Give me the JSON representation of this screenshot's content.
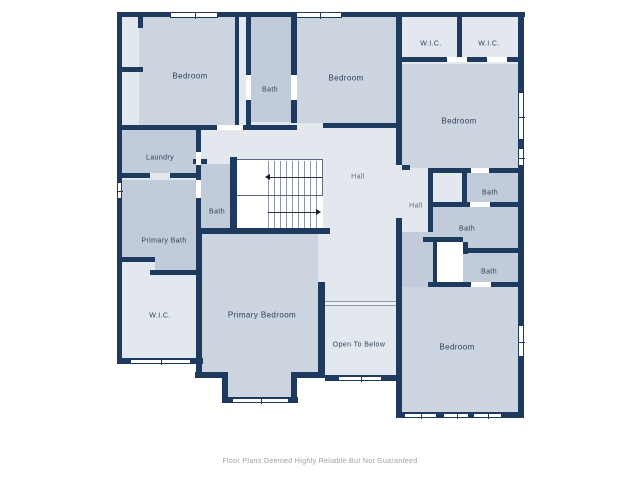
{
  "plan": {
    "colors": {
      "wall": "#1f3a5f",
      "light": "#e3e8ef",
      "med": "#ccd4e0",
      "dark": "#c2cbd9",
      "white": "#ffffff"
    },
    "rooms": [
      {
        "name": "interior-underlay",
        "x": 122,
        "y": 17,
        "w": 396,
        "h": 401,
        "fill": "light"
      },
      {
        "name": "exterior-notch",
        "x": 117,
        "y": 364,
        "w": 86,
        "h": 116,
        "fill": "white"
      },
      {
        "name": "exterior-notch",
        "x": 202,
        "y": 378,
        "w": 20,
        "h": 102,
        "fill": "white"
      },
      {
        "name": "exterior-notch",
        "x": 222,
        "y": 403,
        "w": 76,
        "h": 77,
        "fill": "white"
      },
      {
        "name": "exterior-notch",
        "x": 297,
        "y": 378,
        "w": 28,
        "h": 102,
        "fill": "white"
      },
      {
        "name": "exterior-notch",
        "x": 325,
        "y": 381,
        "w": 72,
        "h": 99,
        "fill": "white"
      },
      {
        "name": "room-bedroom-top-left",
        "x": 139,
        "y": 17,
        "w": 96,
        "h": 108,
        "fill": "med",
        "label": "Bedroom",
        "lx": 190,
        "ly": 76
      },
      {
        "name": "room-bath-top-middle",
        "x": 251,
        "y": 17,
        "w": 40,
        "h": 105,
        "fill": "dark",
        "label": "Bath",
        "lx": 270,
        "ly": 90,
        "cls": "sm"
      },
      {
        "name": "room-bedroom-top-middle",
        "x": 297,
        "y": 17,
        "w": 99,
        "h": 106,
        "fill": "med",
        "label": "Bedroom",
        "lx": 346,
        "ly": 78
      },
      {
        "name": "room-bedroom-right",
        "x": 402,
        "y": 64,
        "w": 116,
        "h": 104,
        "fill": "med",
        "label": "Bedroom",
        "lx": 459,
        "ly": 121
      },
      {
        "name": "room-wic-1",
        "x": 403,
        "y": 22,
        "w": 0,
        "h": 0,
        "fill": "none",
        "label": "W.I.C.",
        "lx": 431,
        "ly": 44,
        "cls": "sm"
      },
      {
        "name": "room-wic-2",
        "x": 464,
        "y": 22,
        "w": 0,
        "h": 0,
        "fill": "none",
        "label": "W.I.C.",
        "lx": 489,
        "ly": 44,
        "cls": "sm"
      },
      {
        "name": "room-laundry",
        "x": 122,
        "y": 130,
        "w": 74,
        "h": 43,
        "fill": "dark",
        "label": "Laundry",
        "lx": 160,
        "ly": 158,
        "cls": "sm"
      },
      {
        "name": "room-bath-center",
        "x": 201,
        "y": 164,
        "w": 33,
        "h": 64,
        "fill": "dark",
        "label": "Bath",
        "lx": 217,
        "ly": 212,
        "cls": "sm"
      },
      {
        "name": "room-primary-bath",
        "x": 122,
        "y": 180,
        "w": 76,
        "h": 77,
        "fill": "dark",
        "label": "Primary Bath",
        "lx": 164,
        "ly": 241,
        "cls": "sm"
      },
      {
        "name": "room-primary-bath-ext",
        "x": 155,
        "y": 257,
        "w": 43,
        "h": 13,
        "fill": "dark"
      },
      {
        "name": "room-wic-left",
        "x": 123,
        "y": 276,
        "w": 0,
        "h": 0,
        "fill": "none",
        "label": "W.I.C.",
        "lx": 160,
        "ly": 316,
        "cls": "sm"
      },
      {
        "name": "room-primary-bedroom",
        "x": 202,
        "y": 234,
        "w": 116,
        "h": 138,
        "fill": "med",
        "label": "Primary Bedroom",
        "lx": 262,
        "ly": 315
      },
      {
        "name": "room-primary-bedroom-bay",
        "x": 228,
        "y": 372,
        "w": 63,
        "h": 25,
        "fill": "med"
      },
      {
        "name": "room-hall-center",
        "x": 330,
        "y": 160,
        "w": 0,
        "h": 0,
        "fill": "none",
        "label": "Hall",
        "lx": 358,
        "ly": 177,
        "cls": "hall"
      },
      {
        "name": "room-hall-small",
        "x": 402,
        "y": 170,
        "w": 0,
        "h": 0,
        "fill": "none",
        "label": "Hall",
        "lx": 416,
        "ly": 206,
        "cls": "hall"
      },
      {
        "name": "room-open-to-below",
        "x": 327,
        "y": 306,
        "w": 0,
        "h": 0,
        "fill": "none",
        "label": "Open To Below",
        "lx": 359,
        "ly": 345,
        "cls": "sm"
      },
      {
        "name": "room-bath-right-top",
        "x": 467,
        "y": 173,
        "w": 51,
        "h": 29,
        "fill": "dark",
        "label": "Bath",
        "lx": 490,
        "ly": 193,
        "cls": "sm"
      },
      {
        "name": "room-bath-right-mid",
        "x": 433,
        "y": 207,
        "w": 85,
        "h": 41,
        "fill": "dark",
        "label": "Bath",
        "lx": 467,
        "ly": 229,
        "cls": "sm"
      },
      {
        "name": "room-bath-corridor",
        "x": 402,
        "y": 232,
        "w": 31,
        "h": 55,
        "fill": "dark"
      },
      {
        "name": "room-bath-right-bottom",
        "x": 463,
        "y": 248,
        "w": 55,
        "h": 34,
        "fill": "dark",
        "label": "Bath",
        "lx": 489,
        "ly": 272,
        "cls": "sm"
      },
      {
        "name": "room-closet-top",
        "x": 433,
        "y": 173,
        "w": 29,
        "h": 29,
        "fill": "light"
      },
      {
        "name": "room-closet-bottom",
        "x": 437,
        "y": 242,
        "w": 26,
        "h": 40,
        "fill": "white"
      },
      {
        "name": "room-bedroom-bottom-right",
        "x": 402,
        "y": 287,
        "w": 116,
        "h": 125,
        "fill": "med",
        "label": "Bedroom",
        "lx": 457,
        "ly": 347
      }
    ],
    "walls": [
      [
        117,
        12,
        408,
        5
      ],
      [
        117,
        67,
        26,
        5
      ],
      [
        117,
        125,
        100,
        5
      ],
      [
        243,
        125,
        54,
        5
      ],
      [
        323,
        123,
        73,
        5
      ],
      [
        117,
        173,
        33,
        5
      ],
      [
        170,
        173,
        28,
        5
      ],
      [
        193,
        159,
        14,
        5
      ],
      [
        117,
        257,
        38,
        5
      ],
      [
        150,
        270,
        48,
        5
      ],
      [
        117,
        358,
        86,
        6
      ],
      [
        196,
        228,
        134,
        6
      ],
      [
        195,
        372,
        33,
        6
      ],
      [
        222,
        397,
        76,
        6
      ],
      [
        291,
        372,
        34,
        6
      ],
      [
        325,
        375,
        77,
        6
      ],
      [
        397,
        57,
        126,
        5
      ],
      [
        402,
        165,
        8,
        5
      ],
      [
        430,
        168,
        93,
        5
      ],
      [
        428,
        202,
        95,
        5
      ],
      [
        423,
        237,
        40,
        5
      ],
      [
        463,
        248,
        55,
        5
      ],
      [
        428,
        282,
        95,
        5
      ],
      [
        397,
        412,
        126,
        6
      ],
      [
        117,
        12,
        5,
        352
      ],
      [
        138,
        17,
        5,
        11
      ],
      [
        235,
        17,
        4,
        108
      ],
      [
        246,
        17,
        5,
        108
      ],
      [
        291,
        17,
        6,
        106
      ],
      [
        396,
        12,
        6,
        153
      ],
      [
        396,
        218,
        6,
        200
      ],
      [
        457,
        16,
        5,
        46
      ],
      [
        518,
        12,
        6,
        406
      ],
      [
        196,
        130,
        5,
        102
      ],
      [
        196,
        232,
        6,
        131
      ],
      [
        230,
        157,
        7,
        75
      ],
      [
        318,
        282,
        7,
        96
      ],
      [
        222,
        372,
        6,
        31
      ],
      [
        291,
        372,
        6,
        31
      ],
      [
        428,
        168,
        5,
        64
      ],
      [
        462,
        173,
        5,
        34
      ],
      [
        433,
        242,
        4,
        45
      ],
      [
        463,
        242,
        5,
        12
      ],
      [
        196,
        358,
        6,
        20
      ]
    ],
    "door_gaps": [
      [
        217,
        125,
        26,
        5
      ],
      [
        246,
        75,
        5,
        25
      ],
      [
        291,
        75,
        6,
        25
      ],
      [
        196,
        152,
        5,
        13
      ],
      [
        196,
        180,
        5,
        18
      ],
      [
        447,
        57,
        20,
        5
      ],
      [
        487,
        57,
        20,
        5
      ],
      [
        471,
        168,
        18,
        5
      ],
      [
        470,
        202,
        20,
        5
      ],
      [
        471,
        282,
        20,
        5
      ]
    ],
    "windows": [
      {
        "x": 170,
        "y": 12,
        "w": 48,
        "h": 6,
        "o": "h"
      },
      {
        "x": 296,
        "y": 12,
        "w": 46,
        "h": 6,
        "o": "h"
      },
      {
        "x": 130,
        "y": 359,
        "w": 61,
        "h": 5,
        "o": "h"
      },
      {
        "x": 232,
        "y": 398,
        "w": 57,
        "h": 5,
        "o": "h"
      },
      {
        "x": 338,
        "y": 376,
        "w": 44,
        "h": 5,
        "o": "h"
      },
      {
        "x": 404,
        "y": 413,
        "w": 33,
        "h": 5,
        "o": "h"
      },
      {
        "x": 443,
        "y": 413,
        "w": 26,
        "h": 5,
        "o": "h"
      },
      {
        "x": 473,
        "y": 413,
        "w": 29,
        "h": 5,
        "o": "h"
      },
      {
        "x": 117,
        "y": 182,
        "w": 5,
        "h": 17,
        "o": "v"
      },
      {
        "x": 518,
        "y": 92,
        "w": 6,
        "h": 48,
        "o": "v"
      },
      {
        "x": 518,
        "y": 148,
        "w": 6,
        "h": 18,
        "o": "v"
      },
      {
        "x": 518,
        "y": 325,
        "w": 6,
        "h": 32,
        "o": "v"
      }
    ],
    "stairs": {
      "well": {
        "x": 237,
        "y": 160,
        "w": 86,
        "h": 70
      },
      "upper_box": {
        "x": 235,
        "y": 159,
        "w": 88,
        "h": 37
      },
      "treads_upper": {
        "x": 268,
        "y": 161,
        "w": 54,
        "h": 34
      },
      "treads_lower": {
        "x": 268,
        "y": 196,
        "w": 54,
        "h": 33
      },
      "line_upper": {
        "x": 270,
        "y": 177,
        "w": 52,
        "h": 1
      },
      "line_lower": {
        "x": 268,
        "y": 212,
        "w": 51,
        "h": 1
      },
      "arrow_upper": {
        "x": 265,
        "y": 174,
        "dir": "left"
      },
      "arrow_lower": {
        "x": 316,
        "y": 209,
        "dir": "right"
      }
    },
    "railing": {
      "x": 325,
      "y": 301,
      "w": 71,
      "h": 5
    }
  },
  "footer": {
    "text": "Floor Plans Deemed Highly Reliable But Not Guaranteed"
  }
}
